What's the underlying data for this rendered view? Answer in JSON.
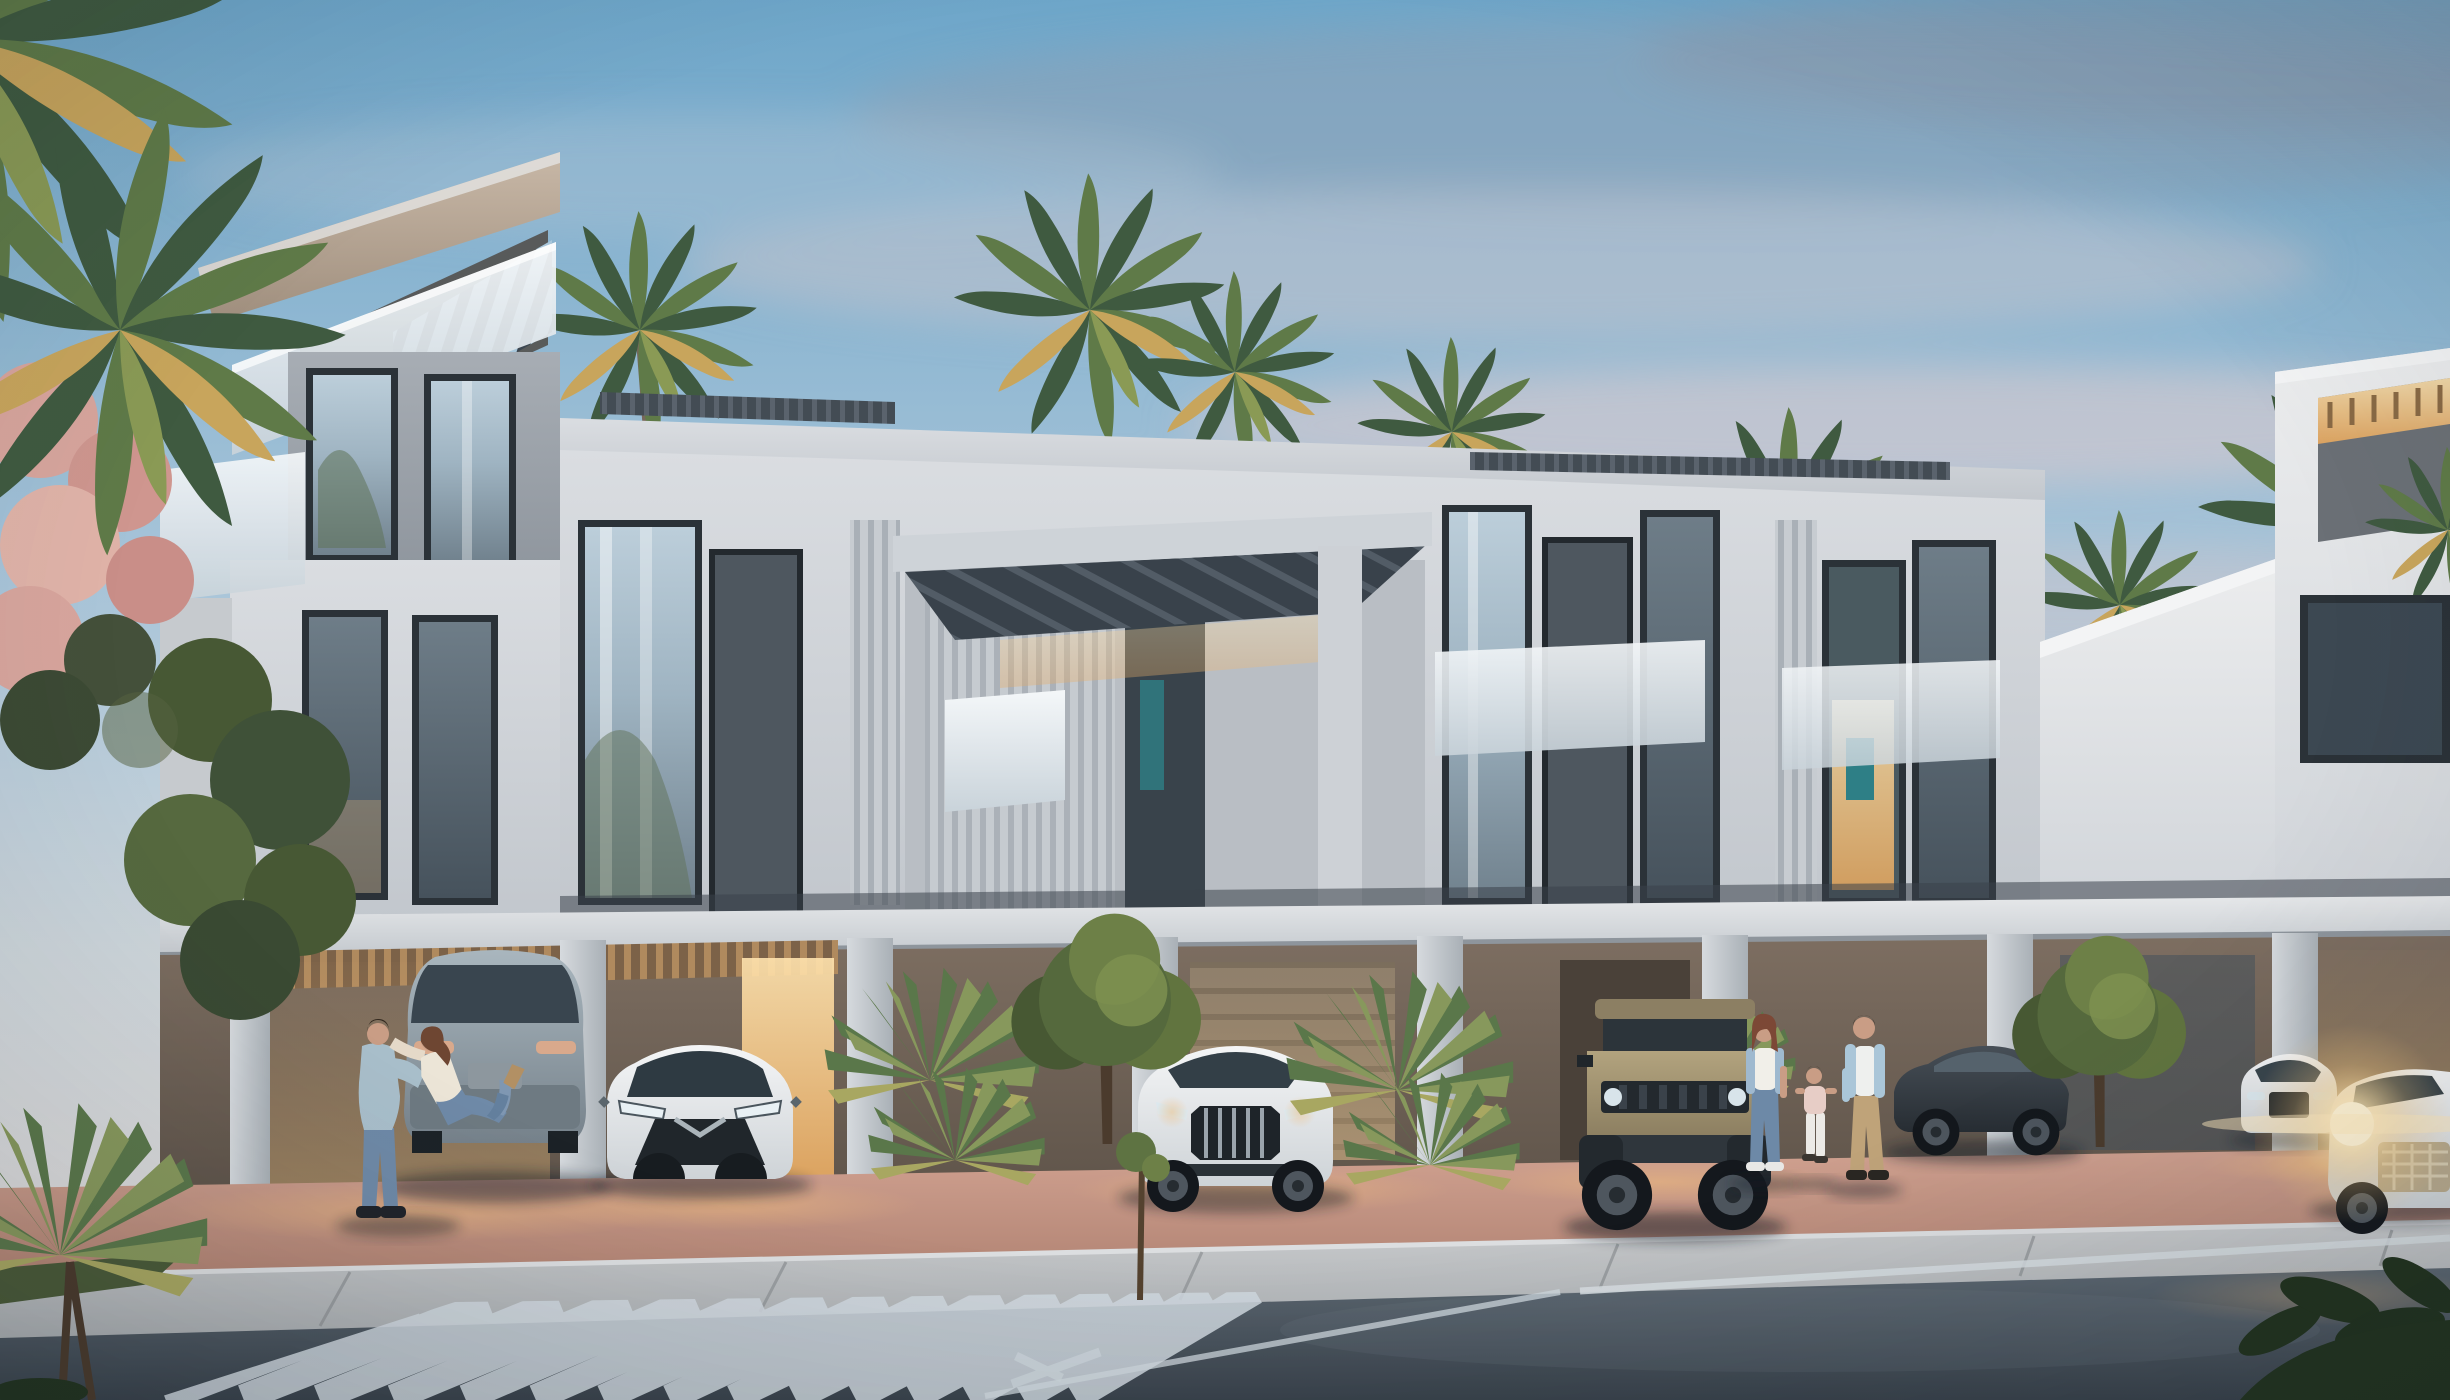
{
  "scene": {
    "kind": "architectural exterior rendering",
    "subject": "Modern two-storey townhouse complex at dusk",
    "time_of_day": "dusk",
    "weather": "partly cloudy, pink-tinged clouds",
    "description": "Row of contemporary beige-and-white townhouses with slatted roof pergolas, frameless glass balconies, floor-to-ceiling glazing and warm-lit covered carports; palm trees behind and beside the building; residents and parked cars along a street with a diagonal striped crosswalk in the foreground."
  },
  "palette": {
    "sky_top": "#6ea6c9",
    "sky_mid": "#a9c5d9",
    "sky_low": "#cdd5da",
    "sky_horizon": "#e6dedb",
    "cloud_slate": "#8fa0b3",
    "cloud_pink": "#d9c9ce",
    "cloud_light": "#e8dcd8",
    "wall_light": "#dadde1",
    "wall_shade": "#c2c7cd",
    "wall_bright": "#ecedee",
    "fascia_tan": "#c8b8a7",
    "fascia_deep": "#a08f7e",
    "box_gray": "#a7adb4",
    "slat_dark": "#3d4650",
    "louver_gray": "#c7ccd1",
    "frame_dark": "#2b3238",
    "glass_light": "#bcceda",
    "glass_deep": "#71828e",
    "balcony_glass": "#f4f7f9",
    "slab_light": "#e6e8ea",
    "pier_light": "#d6dade",
    "ground_floor_dark": "#5f544a",
    "carport_glow": "#f6c57f",
    "interior_teal": "#2e7f86",
    "pavement_pink": "#d0a190",
    "pavement_deep": "#b08272",
    "sidewalk_gray": "#c9cbcd",
    "curb_light": "#dcdee0",
    "road_light": "#5d6872",
    "road_dark": "#39424b",
    "crosswalk_stripe": "#cfd8de",
    "lane_line": "#d7dee2",
    "palm_dark": "#3f5a40",
    "palm_mid": "#5f7a48",
    "palm_gold": "#c8a55c",
    "palm_olive": "#8a9a55",
    "flower_pink": "#d8a59d",
    "tree_green": "#55693d",
    "plant_silhouette": "#22331f",
    "car_grey": "#a9b6be",
    "car_grey_deep": "#76828b",
    "car_white": "#f4f5f6",
    "car_white_deep": "#ced3d7",
    "car_tan": "#b2a37e",
    "car_tan_deep": "#877a5d",
    "car_dark": "#474f57",
    "car_dark_deep": "#272d33",
    "headlight_glow": "#ffe2a8",
    "skin": "#c99d85",
    "denim": "#6f8aa8",
    "khaki": "#bfa379",
    "shirt_blue": "#aac6d8",
    "jacket_denim": "#9fb9cf",
    "tee_white": "#eef0ee",
    "hair_brown": "#7c4836"
  },
  "elements": {
    "building": {
      "left_tower": "three-storey corner unit with angled tan roof slab, diagonal rooftop pergola slats and white glass balcony",
      "row_units": "two-storey units with full-height glazing, dark infill panels, vertical louvre screens and frameless glass balustrades",
      "terrace_pergola": "large dark slatted canopy over recessed first-floor terrace",
      "white_volume": "tall white end volume with slanted parapet",
      "right_tower": "white tower with warm-lit open rooftop pergola and dark glazing band",
      "carports": "warm-lit covered parking bays between light concrete piers"
    },
    "vehicles": [
      {
        "name": "grey SUV, rear view, left carport",
        "color_key": "car_grey"
      },
      {
        "name": "white compact crossover, front view, carport",
        "color_key": "car_white"
      },
      {
        "name": "white luxury SUV with large grille",
        "color_key": "car_white"
      },
      {
        "name": "sand-coloured boxy off-road SUV",
        "color_key": "car_tan"
      },
      {
        "name": "dark sedan, side view behind street tree",
        "color_key": "car_dark"
      },
      {
        "name": "white parked SUV, far right",
        "color_key": "car_white"
      },
      {
        "name": "white SUV driving with headlights on, bottom right",
        "color_key": "car_white"
      }
    ],
    "people": [
      {
        "name": "embracing couple beside grey SUV"
      },
      {
        "name": "mother in denim jacket walking"
      },
      {
        "name": "child walking holding hands"
      },
      {
        "name": "father in open blue shirt walking"
      }
    ],
    "vegetation": [
      "overhanging palm fronds top left",
      "pink flowering tree left edge",
      "palm crowns behind roofline",
      "fan palm clusters at carports",
      "round street trees",
      "sidewalk sapling",
      "dark leaf silhouettes bottom right",
      "foreground fan palm bottom left"
    ],
    "street": [
      "pink paved driveway apron",
      "light sidewalk with curb",
      "dark asphalt road",
      "diagonal striped crosswalk",
      "white lane line and arrow marking"
    ],
    "lighting": [
      "warm amber carport lighting",
      "lit interior window with teal artwork",
      "headlight glow with lens flare",
      "dusk sky gradient"
    ]
  }
}
